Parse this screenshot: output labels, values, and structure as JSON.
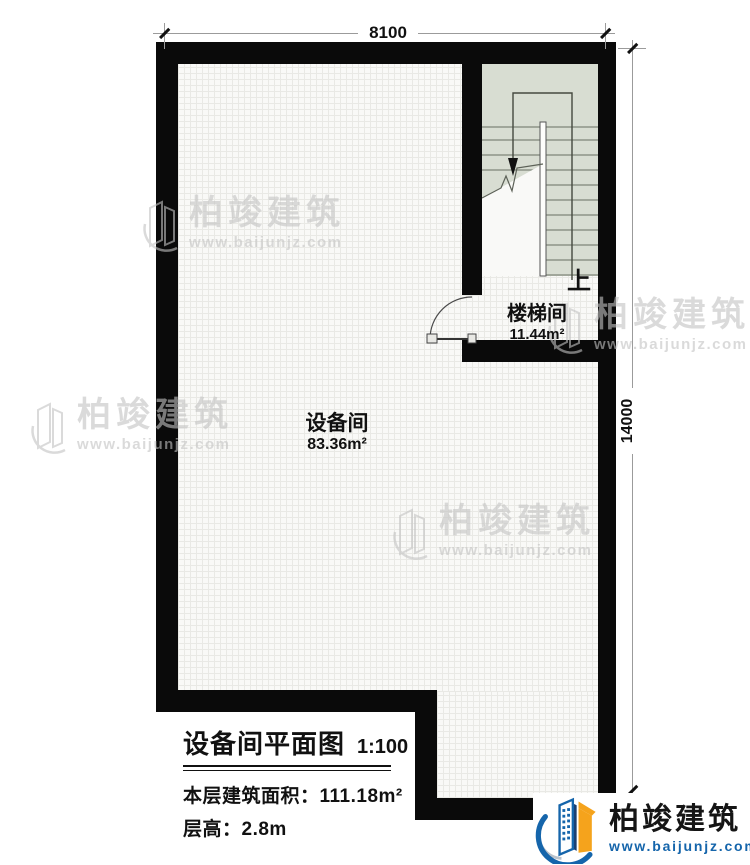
{
  "plan": {
    "dimensions": {
      "top": "8100",
      "right": "14000"
    },
    "rooms": {
      "equipment": {
        "name": "设备间",
        "area": "83.36m²"
      },
      "stairwell": {
        "name": "楼梯间",
        "area": "11.44m²",
        "direction": "上"
      }
    }
  },
  "title_block": {
    "title": "设备间平面图",
    "scale": "1:100",
    "area_label": "本层建筑面积：",
    "area_value": "111.18m²",
    "height_label": "层高：",
    "height_value": "2.8m"
  },
  "watermark": {
    "name": "柏竣建筑",
    "url": "www.baijunjz.com"
  },
  "brand": {
    "name": "柏竣建筑",
    "url": "www.baijunjz.com"
  },
  "colors": {
    "wall": "#0a0a0a",
    "floor": "#f9f9f7",
    "stair_fill": "#d8ddd2",
    "stair_line": "#7e867a",
    "dim_line": "#9b9b9b",
    "brand_blue": "#1565ab",
    "brand_orange": "#f5a31c",
    "watermark": "#c3c3c3"
  }
}
